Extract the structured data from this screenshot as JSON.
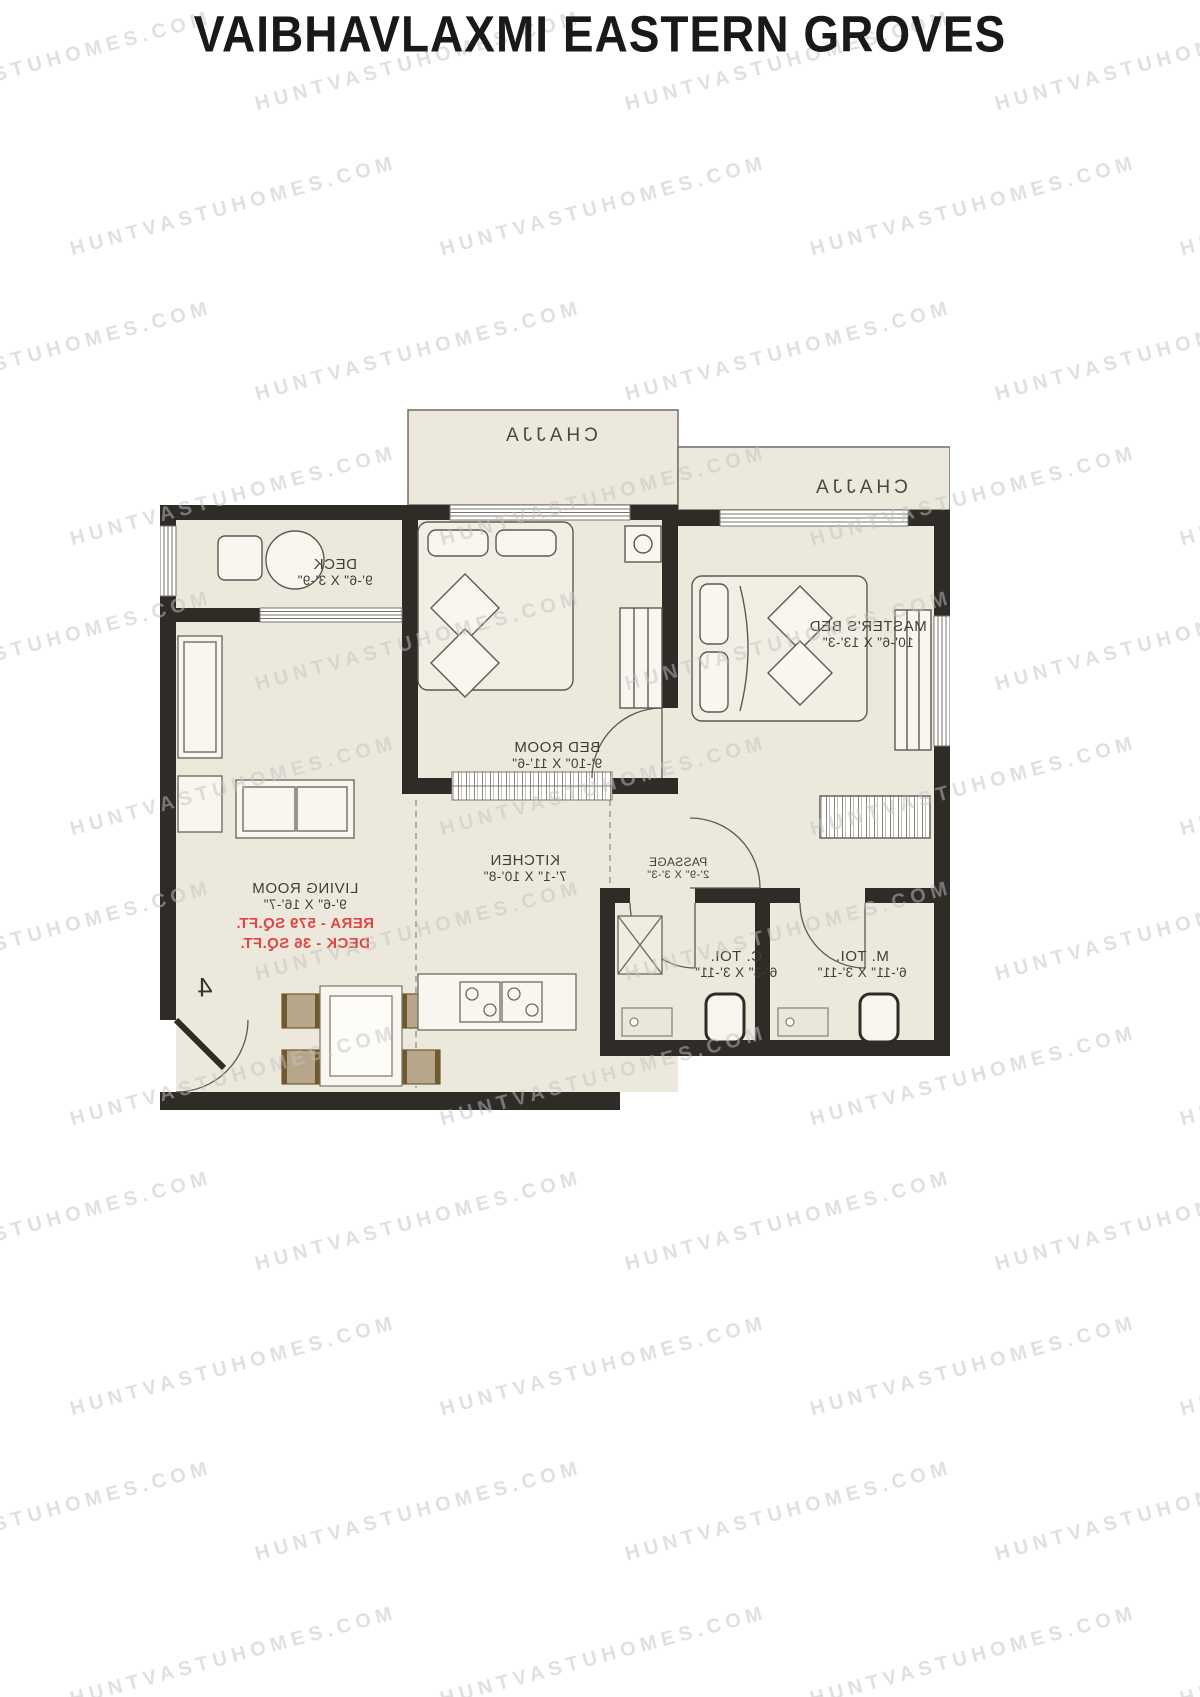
{
  "title": "VAIBHAVLAXMI EASTERN GROVES",
  "watermark": {
    "text": "HUNTVASTUHOMES.COM"
  },
  "plan": {
    "mirrored": true,
    "unit_number": "4",
    "rooms": {
      "chajja_top": {
        "name": "CHAJJA"
      },
      "chajja_right": {
        "name": "CHAJJA"
      },
      "deck": {
        "name": "DECK",
        "dims": "9'-6\" X 3'-9\""
      },
      "bed_room": {
        "name": "BED ROOM",
        "dims": "9'-10\" X 11'-6\""
      },
      "masters_bed": {
        "name": "MASTER'S BED",
        "dims": "10'-6\" X 13'-3\""
      },
      "living_room": {
        "name": "LIVING ROOM",
        "dims": "9'-6\" X 16'-7\""
      },
      "kitchen": {
        "name": "KITCHEN",
        "dims": "7'-1\" X 10'-8\""
      },
      "passage": {
        "name": "PASSAGE",
        "dims": "2'-9\" X 3'-3\""
      },
      "c_toilet": {
        "name": "C. TOI.",
        "dims": "6'-3\" X 3'-11\""
      },
      "m_toilet": {
        "name": "M. TOI.",
        "dims": "6'-11\" X 3'-11\""
      }
    },
    "area_notes": {
      "rera": "RERA - 579 SQ.FT.",
      "deck": "DECK - 36 SQ.FT."
    }
  },
  "colors": {
    "title": "#191919",
    "red_note": "#e04545",
    "walls": "#2f2c28",
    "floor": "#ece9dc",
    "furniture_tan": "#b7a689",
    "furniture_brown": "#6e5a2e",
    "watermark_gray": "#c2c2c2"
  }
}
